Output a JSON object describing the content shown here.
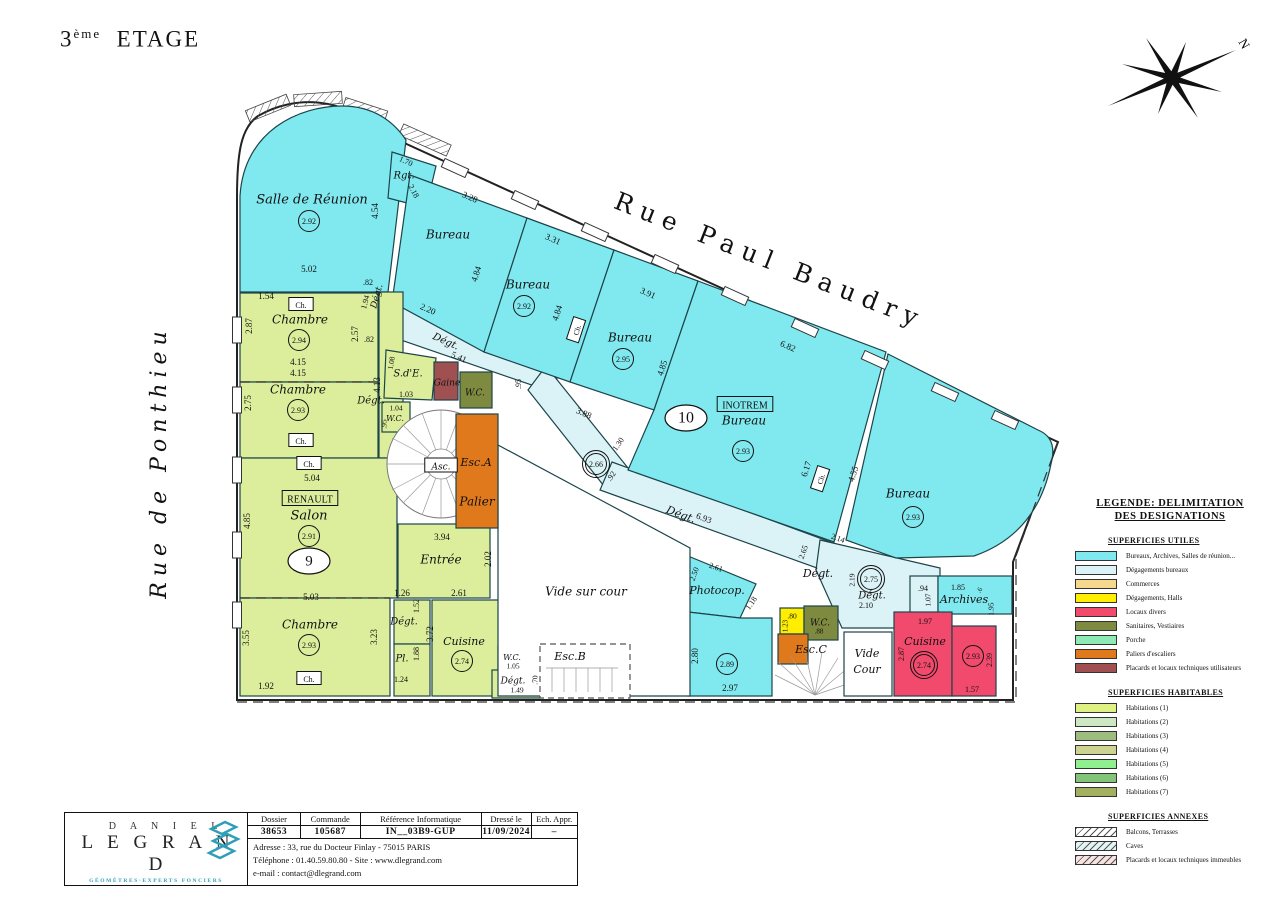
{
  "title": {
    "num": "3",
    "sup": "ème",
    "word": "ETAGE"
  },
  "north_label": "N",
  "streets": {
    "top": "Rue Paul Baudry",
    "left": "Rue de Ponthieu"
  },
  "legend": {
    "title_line1": "LEGENDE: DELIMITATION",
    "title_line2": "DES DESIGNATIONS",
    "sections": [
      {
        "header": "SUPERFICIES UTILES",
        "items": [
          {
            "label": "Bureaux, Archives, Salles de réunion...",
            "color": "#80e9ef",
            "hatch": false
          },
          {
            "label": "Dégagements bureaux",
            "color": "#dbf3f6",
            "hatch": false
          },
          {
            "label": "Commerces",
            "color": "#f5d78e",
            "hatch": false
          },
          {
            "label": "Dégagements, Halls",
            "color": "#ffee00",
            "hatch": false
          },
          {
            "label": "Locaux divers",
            "color": "#f24a6d",
            "hatch": false
          },
          {
            "label": "Sanitaires, Vestiaires",
            "color": "#7d8a3f",
            "hatch": false
          },
          {
            "label": "Porche",
            "color": "#8eeab4",
            "hatch": false
          },
          {
            "label": "Paliers d'escaliers",
            "color": "#e0791c",
            "hatch": false
          },
          {
            "label": "Placards et locaux techniques utilisateurs",
            "color": "#a05050",
            "hatch": false
          }
        ]
      },
      {
        "header": "SUPERFICIES HABITABLES",
        "items": [
          {
            "label": "Habitations (1)",
            "color": "#dff183",
            "hatch": false
          },
          {
            "label": "Habitations (2)",
            "color": "#cde9c4",
            "hatch": false
          },
          {
            "label": "Habitations (3)",
            "color": "#9dbd7e",
            "hatch": false
          },
          {
            "label": "Habitations (4)",
            "color": "#cdd491",
            "hatch": false
          },
          {
            "label": "Habitations (5)",
            "color": "#8ef08e",
            "hatch": false
          },
          {
            "label": "Habitations (6)",
            "color": "#84c37a",
            "hatch": false
          },
          {
            "label": "Habitations (7)",
            "color": "#a3b060",
            "hatch": false
          }
        ]
      },
      {
        "header": "SUPERFICIES ANNEXES",
        "items": [
          {
            "label": "Balcons, Terrasses",
            "color": "#ffffff",
            "hatch": true
          },
          {
            "label": "Caves",
            "color": "#e2f4f4",
            "hatch": true
          },
          {
            "label": "Placards et locaux techniques immeubles",
            "color": "#f8e3e3",
            "hatch": true
          }
        ]
      }
    ]
  },
  "titleblock": {
    "logo_line1": "D A N I E L",
    "logo_line2": "L E G R A N D",
    "logo_sub": "GÉOMÈTRES·EXPERTS FONCIERS",
    "cols": [
      {
        "h": "Dossier",
        "v": "38653"
      },
      {
        "h": "Commande",
        "v": "105687"
      },
      {
        "h": "Référence Informatique",
        "v": "IN__03B9-GUP"
      },
      {
        "h": "Dressé le",
        "v": "11/09/2024"
      },
      {
        "h": "Ech. Appr.",
        "v": "–"
      }
    ],
    "address": "Adresse : 33, rue du Docteur Finlay - 75015 PARIS",
    "phone": "Téléphone : 01.40.59.80.80   -   Site : www.dlegrand.com",
    "email": "e-mail : contact@dlegrand.com"
  },
  "annotations": [
    {
      "t": "Salle de Réunion",
      "x": 312,
      "y": 199,
      "s": 13,
      "i": 1
    },
    {
      "t": "2.92",
      "x": 309,
      "y": 221,
      "c": 1
    },
    {
      "t": "5.02",
      "x": 309,
      "y": 269
    },
    {
      "t": "4.54",
      "x": 375,
      "y": 211,
      "r": -90
    },
    {
      "t": "1.54",
      "x": 266,
      "y": 296
    },
    {
      "t": "Ch.",
      "x": 301,
      "y": 305,
      "box": 1,
      "bf": "#fff",
      "s": 8
    },
    {
      "t": "Chambre",
      "x": 300,
      "y": 319,
      "s": 12,
      "i": 1
    },
    {
      "t": "2.94",
      "x": 299,
      "y": 340,
      "c": 1
    },
    {
      "t": "2.87",
      "x": 249,
      "y": 326,
      "r": -90
    },
    {
      "t": "2.57",
      "x": 355,
      "y": 334,
      "r": -90
    },
    {
      "t": "4.15",
      "x": 298,
      "y": 362
    },
    {
      "t": "4.15",
      "x": 298,
      "y": 373
    },
    {
      "t": "Chambre",
      "x": 298,
      "y": 389,
      "s": 12,
      "i": 1
    },
    {
      "t": "2.93",
      "x": 298,
      "y": 410,
      "c": 1
    },
    {
      "t": "2.75",
      "x": 248,
      "y": 403,
      "r": -90
    },
    {
      "t": "Ch.",
      "x": 301,
      "y": 441,
      "box": 1,
      "bf": "#fff",
      "s": 8
    },
    {
      "t": ".82",
      "x": 368,
      "y": 282,
      "s": 8
    },
    {
      "t": "Dégt.",
      "x": 376,
      "y": 296,
      "r": -75,
      "s": 9,
      "i": 1
    },
    {
      "t": "1.94",
      "x": 365,
      "y": 302,
      "r": -75,
      "s": 8
    },
    {
      "t": ".82",
      "x": 369,
      "y": 339,
      "s": 8
    },
    {
      "t": "4.13",
      "x": 377,
      "y": 385,
      "r": -90
    },
    {
      "t": "Dégt.",
      "x": 371,
      "y": 400,
      "s": 10,
      "i": 1
    },
    {
      "t": "1.70",
      "x": 406,
      "y": 161,
      "r": 24,
      "s": 8
    },
    {
      "t": "Rgt.",
      "x": 404,
      "y": 175,
      "s": 10,
      "i": 1
    },
    {
      "t": "2.18",
      "x": 414,
      "y": 191,
      "r": 62,
      "s": 8
    },
    {
      "t": "Ch.",
      "x": 309,
      "y": 464,
      "box": 1,
      "bf": "#fff",
      "s": 8
    },
    {
      "t": "5.04",
      "x": 312,
      "y": 478
    },
    {
      "t": "RENAULT",
      "x": 310,
      "y": 499,
      "box": 1,
      "s": 10
    },
    {
      "t": "Salon",
      "x": 309,
      "y": 515,
      "s": 13,
      "i": 1
    },
    {
      "t": "2.91",
      "x": 309,
      "y": 536,
      "c": 1
    },
    {
      "t": "9",
      "x": 309,
      "y": 561,
      "o": 1,
      "s": 15
    },
    {
      "t": "4.85",
      "x": 247,
      "y": 521,
      "r": -90
    },
    {
      "t": "5.03",
      "x": 311,
      "y": 597
    },
    {
      "t": "Chambre",
      "x": 310,
      "y": 624,
      "s": 12,
      "i": 1
    },
    {
      "t": "2.93",
      "x": 309,
      "y": 645,
      "c": 1
    },
    {
      "t": "3.55",
      "x": 246,
      "y": 638,
      "r": -90
    },
    {
      "t": "3.23",
      "x": 374,
      "y": 637,
      "r": -90
    },
    {
      "t": "Ch.",
      "x": 309,
      "y": 679,
      "box": 1,
      "bf": "#fff",
      "s": 8
    },
    {
      "t": "1.92",
      "x": 266,
      "y": 686
    },
    {
      "t": "Asc.",
      "x": 441,
      "y": 466,
      "box": 1,
      "bf": "#fff",
      "s": 9,
      "i": 1
    },
    {
      "t": "Esc.A",
      "x": 476,
      "y": 462,
      "s": 11,
      "i": 1
    },
    {
      "t": "Palier",
      "x": 477,
      "y": 501,
      "s": 12,
      "i": 1
    },
    {
      "t": "3.94",
      "x": 442,
      "y": 537
    },
    {
      "t": "Entrée",
      "x": 441,
      "y": 559,
      "s": 12,
      "i": 1
    },
    {
      "t": "2.02",
      "x": 488,
      "y": 559,
      "r": -90
    },
    {
      "t": "1.26",
      "x": 402,
      "y": 593
    },
    {
      "t": "2.61",
      "x": 459,
      "y": 593
    },
    {
      "t": "1.52",
      "x": 416,
      "y": 606,
      "r": -90,
      "s": 8
    },
    {
      "t": "Dégt.",
      "x": 404,
      "y": 621,
      "s": 10,
      "i": 1
    },
    {
      "t": "Pl.",
      "x": 402,
      "y": 658,
      "s": 10,
      "i": 1
    },
    {
      "t": "1.88",
      "x": 416,
      "y": 654,
      "r": -90,
      "s": 8
    },
    {
      "t": "1.24",
      "x": 401,
      "y": 679,
      "s": 8
    },
    {
      "t": "3.72",
      "x": 430,
      "y": 634,
      "r": -90
    },
    {
      "t": "Cuisine",
      "x": 464,
      "y": 641,
      "s": 11,
      "i": 1
    },
    {
      "t": "2.74",
      "x": 462,
      "y": 661,
      "c": 1
    },
    {
      "t": "W.C.",
      "x": 512,
      "y": 657,
      "s": 8,
      "i": 1
    },
    {
      "t": "1.05",
      "x": 513,
      "y": 666,
      "s": 7.5
    },
    {
      "t": "Dégt.",
      "x": 513,
      "y": 680,
      "s": 9,
      "i": 1
    },
    {
      "t": "1.49",
      "x": 517,
      "y": 690,
      "s": 7.5
    },
    {
      "t": ".70",
      "x": 535,
      "y": 680,
      "r": -90,
      "s": 7.5
    },
    {
      "t": "Esc.B",
      "x": 570,
      "y": 656,
      "s": 11,
      "i": 1
    },
    {
      "t": "Vide sur cour",
      "x": 586,
      "y": 591,
      "s": 12,
      "i": 1
    },
    {
      "t": "S.d'E.",
      "x": 408,
      "y": 373,
      "s": 10,
      "i": 1
    },
    {
      "t": "1.08",
      "x": 391,
      "y": 363,
      "r": -80,
      "s": 7.5
    },
    {
      "t": "1.03",
      "x": 406,
      "y": 394,
      "s": 8
    },
    {
      "t": "Gaine",
      "x": 447,
      "y": 382,
      "s": 9,
      "i": 1
    },
    {
      "t": "W.C.",
      "x": 475,
      "y": 392,
      "s": 9,
      "i": 1
    },
    {
      "t": "1.04",
      "x": 396,
      "y": 408,
      "s": 7.5
    },
    {
      "t": "W.C.",
      "x": 395,
      "y": 418,
      "s": 8,
      "i": 1
    },
    {
      "t": ".95",
      "x": 384,
      "y": 424,
      "r": -90,
      "s": 7.5
    },
    {
      "t": "Dégt.",
      "x": 446,
      "y": 341,
      "r": 24,
      "s": 10,
      "i": 1
    },
    {
      "t": "5.41",
      "x": 459,
      "y": 357,
      "r": 24
    },
    {
      "t": "2.20",
      "x": 428,
      "y": 309,
      "r": 24
    },
    {
      "t": ".95",
      "x": 518,
      "y": 384,
      "r": -90,
      "s": 8
    },
    {
      "t": "Bureau",
      "x": 448,
      "y": 234,
      "s": 12,
      "i": 1
    },
    {
      "t": "3.28",
      "x": 470,
      "y": 197,
      "r": 24
    },
    {
      "t": "Bureau",
      "x": 528,
      "y": 284,
      "s": 12,
      "i": 1
    },
    {
      "t": "2.92",
      "x": 524,
      "y": 306,
      "c": 1
    },
    {
      "t": "3.31",
      "x": 553,
      "y": 239,
      "r": 24
    },
    {
      "t": "4.84",
      "x": 476,
      "y": 274,
      "r": -72
    },
    {
      "t": "4.84",
      "x": 557,
      "y": 313,
      "r": -72
    },
    {
      "t": "Ch.",
      "x": 577,
      "y": 330,
      "box": 1,
      "bf": "#fff",
      "s": 7.5,
      "r": -72
    },
    {
      "t": "Bureau",
      "x": 630,
      "y": 337,
      "s": 12,
      "i": 1
    },
    {
      "t": "2.95",
      "x": 623,
      "y": 359,
      "c": 1
    },
    {
      "t": "3.91",
      "x": 648,
      "y": 293,
      "r": 24
    },
    {
      "t": "4.85",
      "x": 662,
      "y": 368,
      "r": -72
    },
    {
      "t": "INOTREM",
      "x": 745,
      "y": 405,
      "box": 1,
      "s": 10
    },
    {
      "t": "Bureau",
      "x": 744,
      "y": 420,
      "s": 12,
      "i": 1
    },
    {
      "t": "2.93",
      "x": 743,
      "y": 451,
      "c": 1
    },
    {
      "t": "10",
      "x": 686,
      "y": 418,
      "o": 1,
      "s": 16
    },
    {
      "t": "6.82",
      "x": 788,
      "y": 346,
      "r": 24
    },
    {
      "t": "3.88",
      "x": 584,
      "y": 413,
      "r": 24
    },
    {
      "t": "1.30",
      "x": 618,
      "y": 444,
      "r": -55,
      "s": 8
    },
    {
      "t": "2.66",
      "x": 596,
      "y": 464,
      "c2": 1
    },
    {
      "t": ".92",
      "x": 611,
      "y": 476,
      "r": -55,
      "s": 8
    },
    {
      "t": "Dégt.",
      "x": 681,
      "y": 514,
      "r": 20,
      "s": 11,
      "i": 1
    },
    {
      "t": "6.93",
      "x": 704,
      "y": 518,
      "r": 20
    },
    {
      "t": "6.17",
      "x": 806,
      "y": 469,
      "r": -72
    },
    {
      "t": "Ch.",
      "x": 821,
      "y": 479,
      "box": 1,
      "bf": "#fff",
      "s": 7.5,
      "r": -72
    },
    {
      "t": "4.55",
      "x": 853,
      "y": 474,
      "r": -72
    },
    {
      "t": "Bureau",
      "x": 908,
      "y": 493,
      "s": 12,
      "i": 1
    },
    {
      "t": "2.93",
      "x": 913,
      "y": 517,
      "c": 1
    },
    {
      "t": "2.14",
      "x": 838,
      "y": 538,
      "r": 20,
      "s": 8
    },
    {
      "t": "2.65",
      "x": 803,
      "y": 552,
      "r": -70,
      "s": 8
    },
    {
      "t": "Dégt.",
      "x": 818,
      "y": 573,
      "s": 11,
      "i": 1
    },
    {
      "t": "2.19",
      "x": 852,
      "y": 580,
      "r": -90,
      "s": 7.5
    },
    {
      "t": "2.75",
      "x": 871,
      "y": 579,
      "c2": 1
    },
    {
      "t": "Dégt.",
      "x": 872,
      "y": 595,
      "s": 10,
      "i": 1
    },
    {
      "t": "2.10",
      "x": 866,
      "y": 605,
      "s": 8
    },
    {
      "t": ".94",
      "x": 923,
      "y": 588,
      "s": 8
    },
    {
      "t": "1.07",
      "x": 928,
      "y": 600,
      "r": -90,
      "s": 7.5
    },
    {
      "t": "1.85",
      "x": 958,
      "y": 587,
      "s": 8
    },
    {
      "t": "Archives",
      "x": 964,
      "y": 599,
      "s": 11,
      "i": 1
    },
    {
      "t": ".6",
      "x": 979,
      "y": 590,
      "r": -60,
      "s": 7
    },
    {
      "t": "1.95",
      "x": 991,
      "y": 609,
      "r": -90,
      "s": 7.5
    },
    {
      "t": "2.61",
      "x": 716,
      "y": 567,
      "r": 20,
      "s": 8
    },
    {
      "t": "2.50",
      "x": 694,
      "y": 574,
      "r": -70,
      "s": 8
    },
    {
      "t": "Photocop.",
      "x": 717,
      "y": 590,
      "s": 11,
      "i": 1
    },
    {
      "t": "1.18",
      "x": 751,
      "y": 603,
      "r": -55,
      "s": 8
    },
    {
      "t": "2.89",
      "x": 727,
      "y": 664,
      "c": 1
    },
    {
      "t": "2.80",
      "x": 695,
      "y": 656,
      "r": -90
    },
    {
      "t": "2.97",
      "x": 730,
      "y": 688
    },
    {
      "t": ".80",
      "x": 792,
      "y": 616,
      "s": 7.5
    },
    {
      "t": "1.23",
      "x": 785,
      "y": 626,
      "r": -90,
      "s": 7
    },
    {
      "t": "W.C.",
      "x": 820,
      "y": 622,
      "s": 9,
      "i": 1
    },
    {
      "t": ".88",
      "x": 819,
      "y": 631,
      "s": 7
    },
    {
      "t": "Esc.C",
      "x": 811,
      "y": 649,
      "s": 11,
      "i": 1
    },
    {
      "t": "Vide",
      "x": 867,
      "y": 653,
      "s": 11,
      "i": 1
    },
    {
      "t": "Cour",
      "x": 867,
      "y": 669,
      "s": 11,
      "i": 1
    },
    {
      "t": "Cuisine",
      "x": 925,
      "y": 641,
      "s": 11,
      "i": 1
    },
    {
      "t": "2.74",
      "x": 924,
      "y": 665,
      "c2": 1
    },
    {
      "t": "1.97",
      "x": 925,
      "y": 621,
      "s": 8
    },
    {
      "t": "2.87",
      "x": 901,
      "y": 654,
      "r": -90,
      "s": 8
    },
    {
      "t": "2.93",
      "x": 973,
      "y": 656,
      "c": 1
    },
    {
      "t": "2.39",
      "x": 989,
      "y": 660,
      "r": -90,
      "s": 8
    },
    {
      "t": "1.57",
      "x": 972,
      "y": 689,
      "s": 8
    }
  ]
}
